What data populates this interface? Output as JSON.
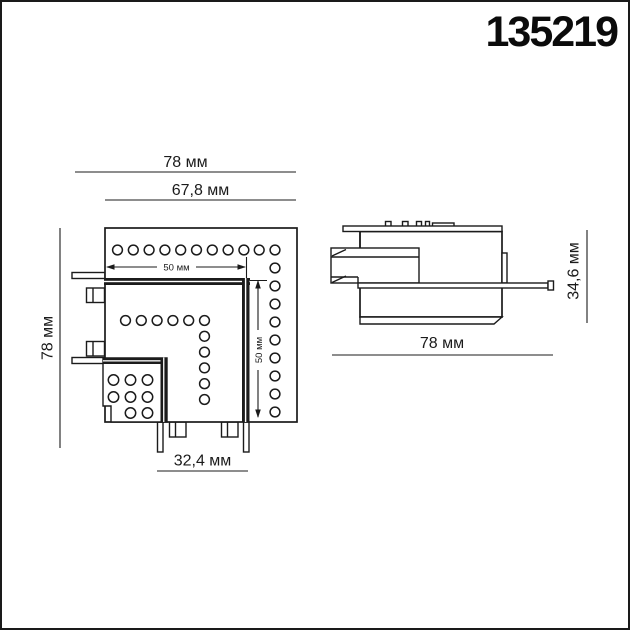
{
  "article_number": "135219",
  "colors": {
    "line": "#1b1b1b",
    "background": "#ffffff"
  },
  "top_view": {
    "dimensions": {
      "outer_width": "78 мм",
      "inner_width": "67,8 мм",
      "outer_height": "78 мм",
      "slot_width": "50 мм",
      "slot_height": "50 мм",
      "connector_width": "32,4 мм"
    }
  },
  "side_view": {
    "dimensions": {
      "width": "78 мм",
      "height": "34,6 мм"
    }
  }
}
